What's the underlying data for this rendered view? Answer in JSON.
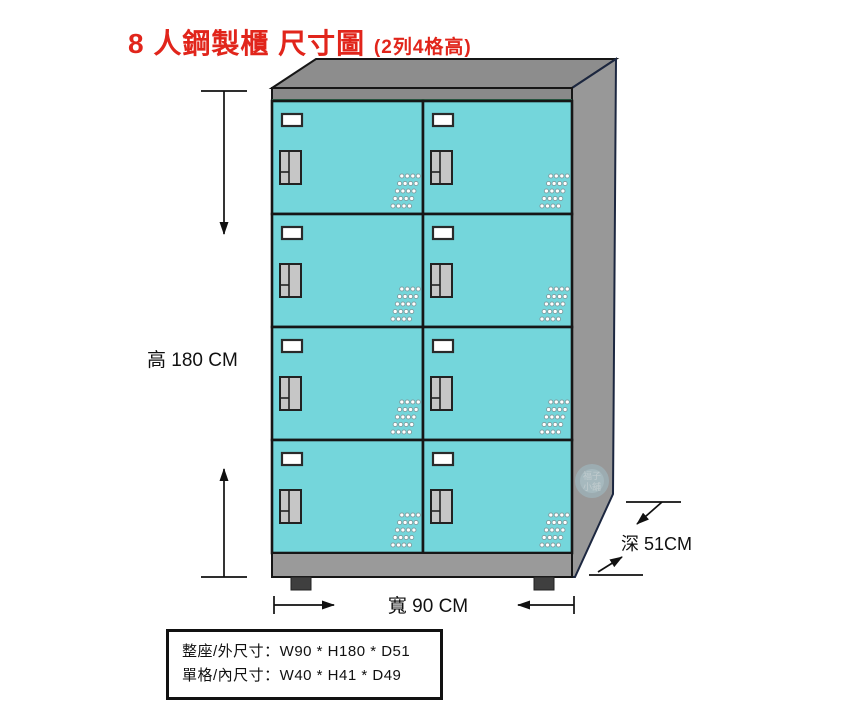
{
  "title": {
    "main": "8 人鋼製櫃 尺寸圖",
    "suffix": "(2列4格高)"
  },
  "cabinet": {
    "columns": 2,
    "rows": 4,
    "door_count": 8
  },
  "dimensions": {
    "height_label": "高 180 CM",
    "width_label": "寬 90 CM",
    "depth_label": "深 51CM"
  },
  "spec_box": {
    "line1": "整座/外尺寸：W90 * H180 * D51",
    "line2": "單格/內尺寸：W40 * H41 * D49"
  },
  "watermark": {
    "line1": "福子",
    "line2": "小舖"
  },
  "colors": {
    "title": "#e1251b",
    "door": "#74d6db",
    "top_face": "#8d8d8d",
    "side_panel": "#989898",
    "fascia": "#8a8a8a",
    "base": "#9a9a9a",
    "feet": "#3f3f3f",
    "handle": "#c6c6c6",
    "outline": "#161616"
  }
}
